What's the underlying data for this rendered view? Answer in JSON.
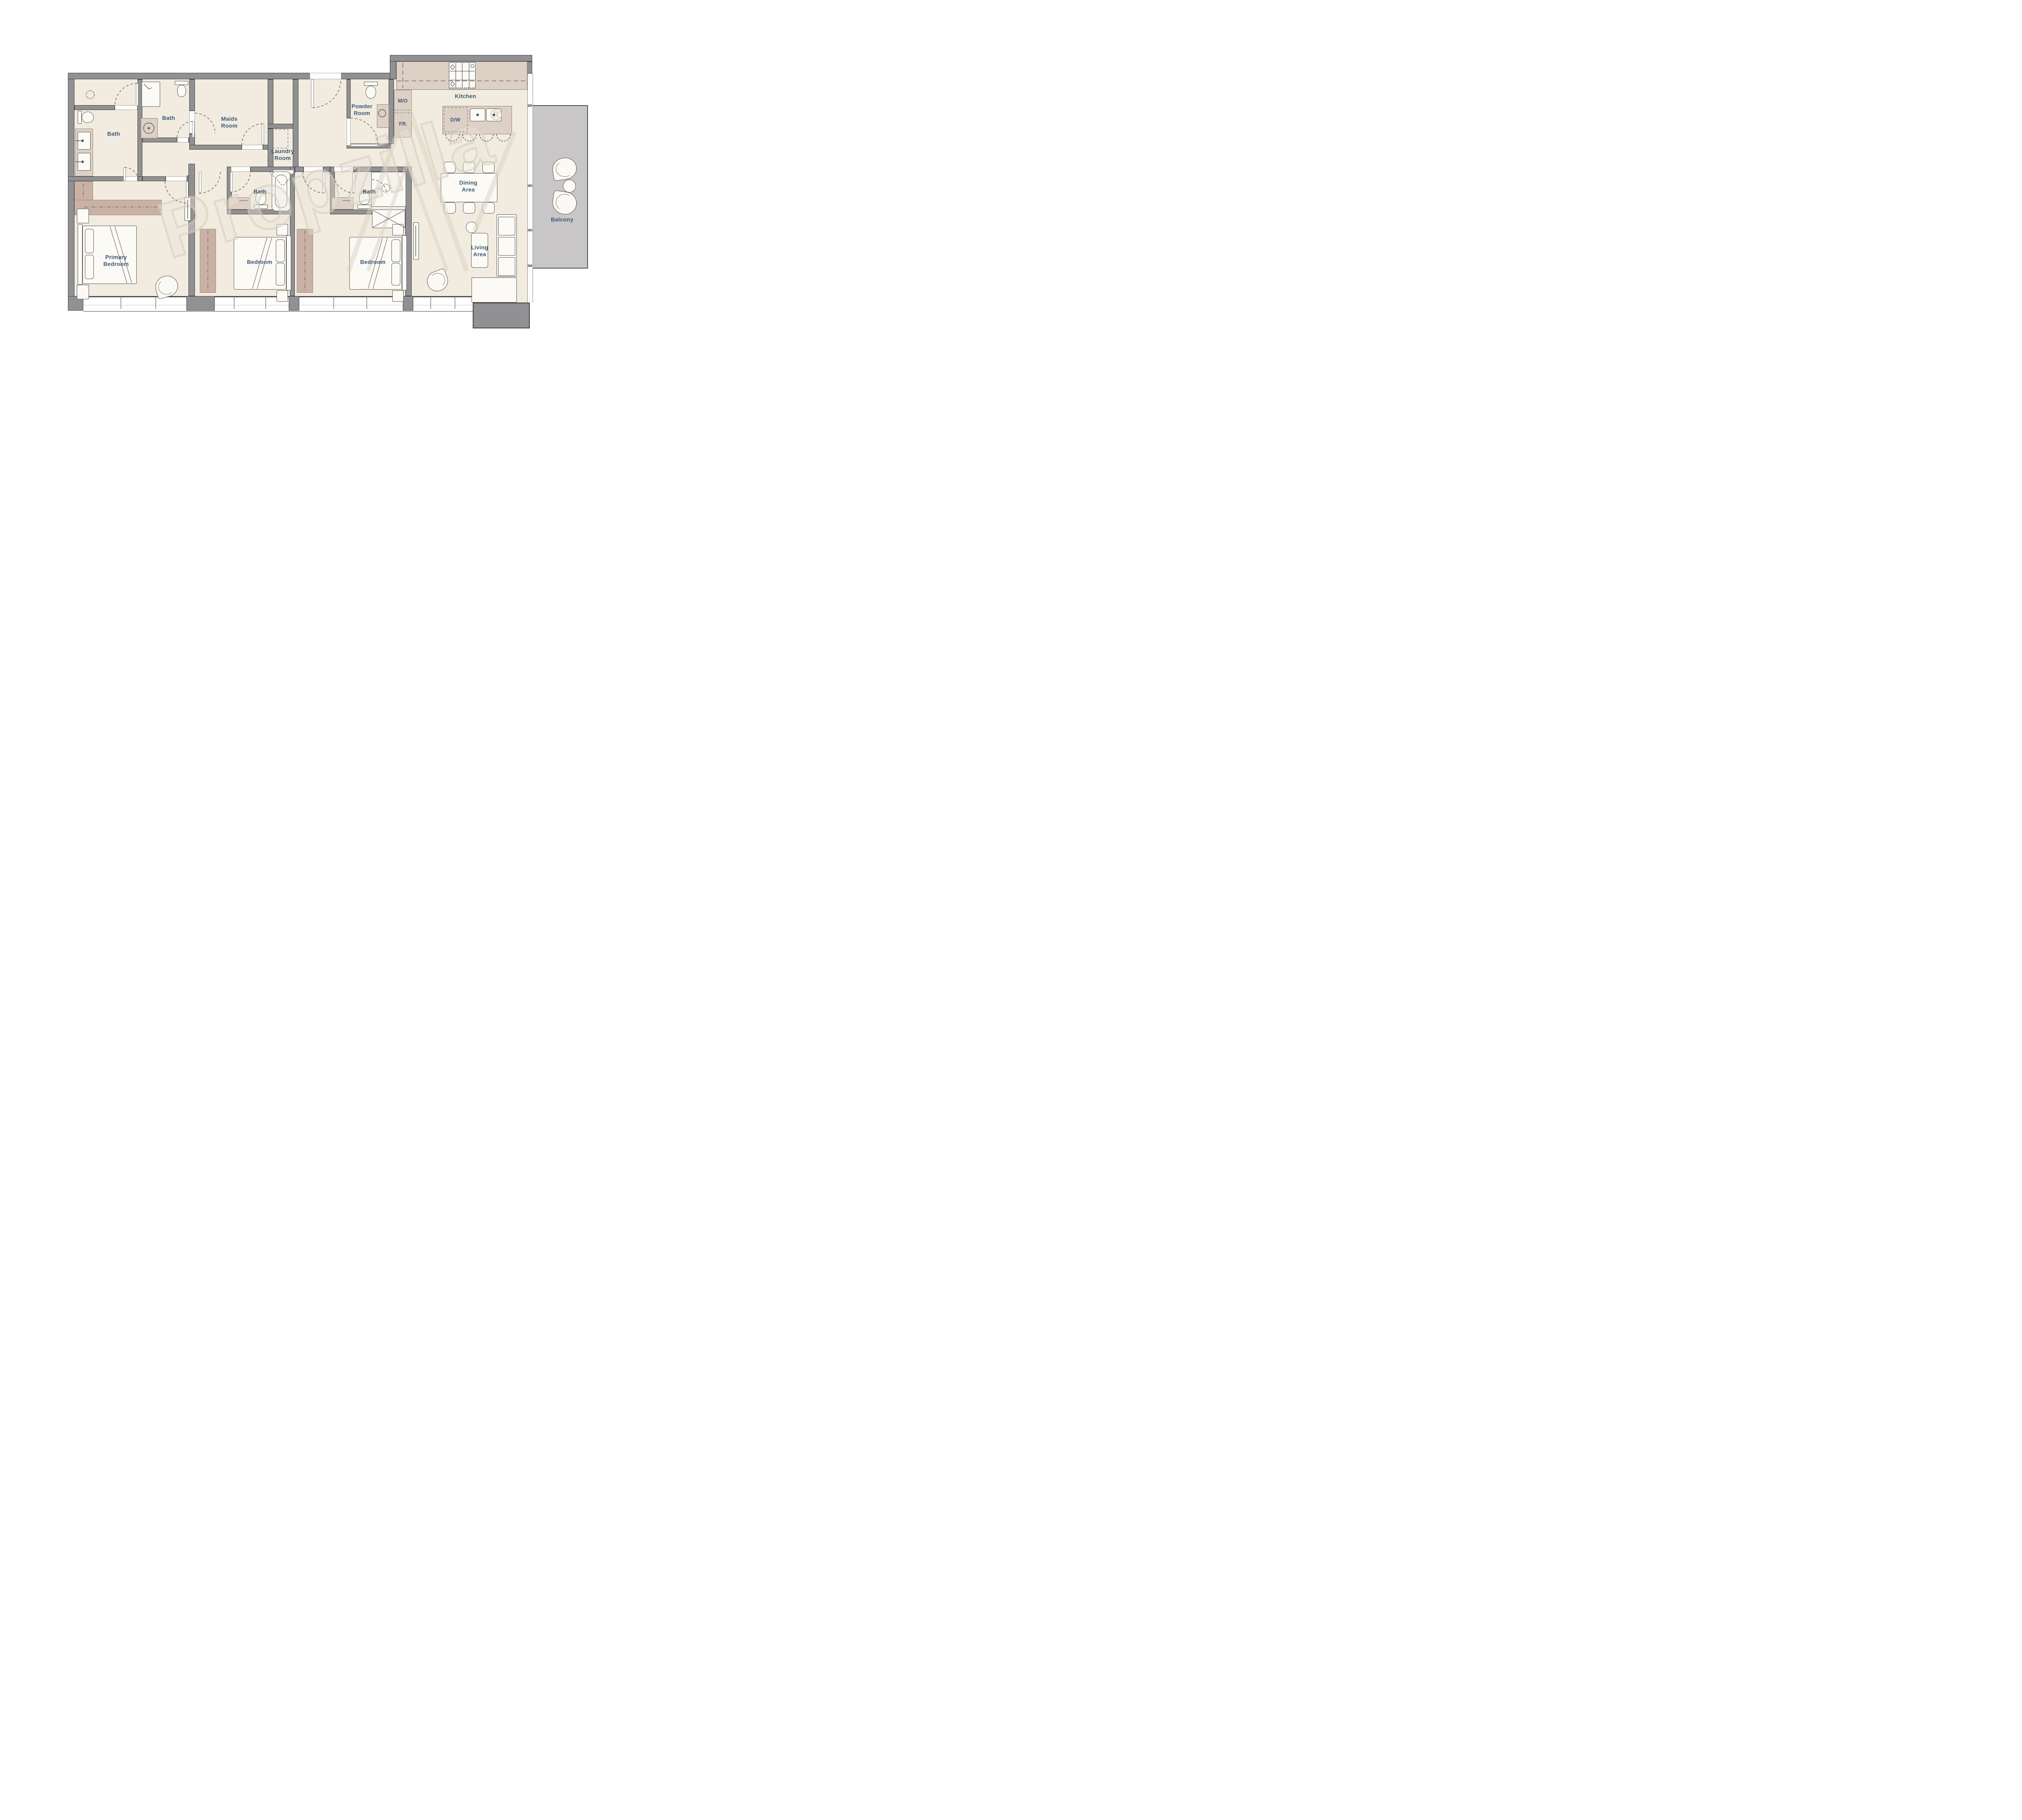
{
  "title": "Apartment Floor Plan",
  "watermark": {
    "text": "Propzilla",
    "registered": "®"
  },
  "rooms": {
    "bath_primary": {
      "label": "Bath"
    },
    "bath_shared": {
      "label": "Bath"
    },
    "maids": {
      "label": "Maids\nRoom"
    },
    "laundry": {
      "label": "Laundry\nRoom"
    },
    "powder": {
      "label": "Powder\nRoom"
    },
    "kitchen": {
      "label": "Kitchen"
    },
    "dining": {
      "label": "Dining\nArea"
    },
    "living": {
      "label": "Living\nArea"
    },
    "balcony": {
      "label": "Balcony"
    },
    "primary_bedroom": {
      "label": "Primary\nBedroom"
    },
    "bedroom_2": {
      "label": "Bedroom"
    },
    "bedroom_3": {
      "label": "Bedroom"
    },
    "bath_bedroom_2": {
      "label": "Bath"
    },
    "bath_bedroom_3": {
      "label": "Bath"
    }
  },
  "kitchen_appliances": {
    "microwave_oven": "M/O",
    "fridge": "FR.",
    "dishwasher": "D/W"
  },
  "colors": {
    "wall": "#919093",
    "floor": "#f1ecdf",
    "counter": "#ddd0c5",
    "wardrobe": "#c9b2a3",
    "balcony": "#c8c6c7",
    "label_text": "#3d5a78",
    "watermark": "#d6ccbc"
  }
}
